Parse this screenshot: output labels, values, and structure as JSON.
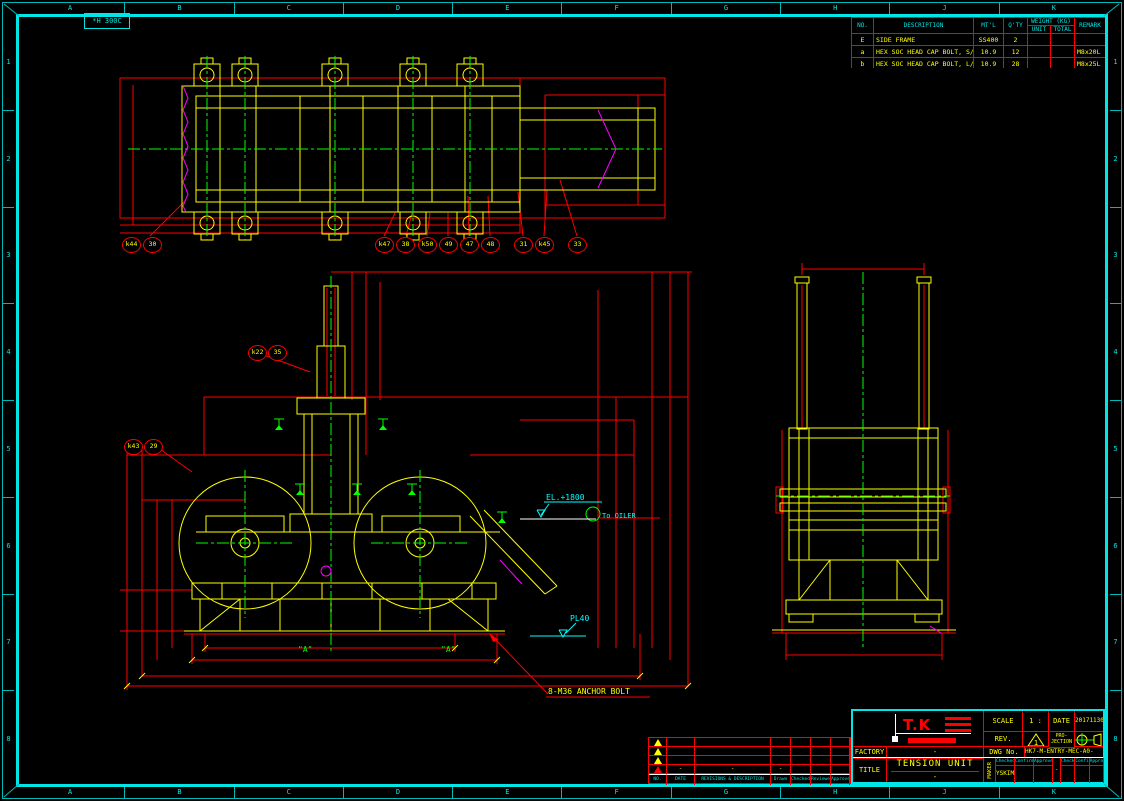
{
  "stamp": {
    "text": "*H 300C"
  },
  "border": {
    "top_letters": [
      "A",
      "B",
      "C",
      "D",
      "E",
      "F",
      "G",
      "H",
      "J",
      "K"
    ],
    "bottom_letters": [
      "A",
      "B",
      "C",
      "D",
      "E",
      "F",
      "G",
      "H",
      "J",
      "K"
    ],
    "left_numbers": [
      "1",
      "2",
      "3",
      "4",
      "5",
      "6",
      "7",
      "8"
    ],
    "right_numbers": [
      "1",
      "2",
      "3",
      "4",
      "5",
      "6",
      "7",
      "8"
    ]
  },
  "parts_table": {
    "col_no": "NO.",
    "col_description": "DESCRIPTION",
    "col_mtl": "MT'L",
    "col_qty": "Q'TY",
    "col_weight": "WEIGHT (KG)",
    "col_unit": "UNIT",
    "col_total": "TOTAL",
    "col_remark": "REMARK",
    "rows": [
      {
        "no": "E",
        "description": "SIDE FRAME",
        "mtl": "SS400",
        "qty": "2",
        "unit": "",
        "total": "",
        "remark": ""
      },
      {
        "no": "a",
        "description": "HEX SOC HEAD CAP BOLT, S/W",
        "mtl": "10.9",
        "qty": "12",
        "unit": "",
        "total": "",
        "remark": "M8x20L"
      },
      {
        "no": "b",
        "description": "HEX SOC HEAD CAP BOLT, L/W",
        "mtl": "10.9",
        "qty": "28",
        "unit": "",
        "total": "",
        "remark": "M8x25L"
      }
    ]
  },
  "balloons": [
    {
      "x": 131,
      "y": 244,
      "label": "k44"
    },
    {
      "x": 152,
      "y": 244,
      "label": "30"
    },
    {
      "x": 384,
      "y": 244,
      "label": "k47"
    },
    {
      "x": 405,
      "y": 244,
      "label": "38"
    },
    {
      "x": 427,
      "y": 244,
      "label": "k50"
    },
    {
      "x": 448,
      "y": 244,
      "label": "49"
    },
    {
      "x": 469,
      "y": 244,
      "label": "47"
    },
    {
      "x": 490,
      "y": 244,
      "label": "48"
    },
    {
      "x": 523,
      "y": 244,
      "label": "31"
    },
    {
      "x": 544,
      "y": 244,
      "label": "k45"
    },
    {
      "x": 577,
      "y": 244,
      "label": "33"
    },
    {
      "x": 257,
      "y": 352,
      "label": "k22"
    },
    {
      "x": 277,
      "y": 352,
      "label": "35"
    },
    {
      "x": 133,
      "y": 446,
      "label": "k43"
    },
    {
      "x": 153,
      "y": 446,
      "label": "29"
    }
  ],
  "annotations": {
    "elevation": "EL.+1800",
    "oiler": "To OILER",
    "plate": "PL40",
    "anchor_bolt": "8-M36 ANCHOR BOLT",
    "section_a_left": "\"A\"",
    "section_a_right": "\"A\""
  },
  "title_block": {
    "logo": "T.K",
    "scale_label": "SCALE",
    "scale_value": "1 : 20",
    "date_label": "DATE",
    "date_value": "20171130",
    "rev_label": "REV.",
    "rev_value": "1",
    "projection_label_top": "PRO-",
    "projection_label_bottom": "JECTION",
    "dwg_label": "DWG No.",
    "dwg_value": "HK7-M-ENTRY-MEC-A0-102",
    "factory_label": "FACTORY",
    "factory_value": "-",
    "title_label": "TITLE",
    "title_value": "TENSION UNIT",
    "title_sub": "-",
    "maker_label": "MAKER",
    "maker_value": "YSKIM",
    "sign_divider": "-",
    "sign_cols": [
      "Checked",
      "Confirmed",
      "Approved",
      "Checked",
      "Confirmed",
      "Approved"
    ]
  },
  "revision_table": {
    "headers": [
      "NO.",
      "DATE",
      "REVISIONS & DESCRIPTION",
      "Drawn",
      "Checked",
      "Reviewed",
      "Approved"
    ],
    "rows": [
      {
        "date": "",
        "description": "",
        "drawn": "",
        "checked": "",
        "reviewed": "",
        "approved": ""
      },
      {
        "date": "",
        "description": "",
        "drawn": "",
        "checked": "",
        "reviewed": "",
        "approved": ""
      },
      {
        "date": "",
        "description": "",
        "drawn": "",
        "checked": "",
        "reviewed": "",
        "approved": ""
      },
      {
        "date": "-",
        "description": "-",
        "drawn": "-",
        "checked": "",
        "reviewed": "",
        "approved": ""
      }
    ]
  },
  "colors": {
    "frame_cyan": "#00e5e5",
    "dim_red": "#ff0000",
    "geometry_yellow": "#ffff00",
    "centerline_green": "#00ff00",
    "accent_magenta": "#ff00ff"
  }
}
